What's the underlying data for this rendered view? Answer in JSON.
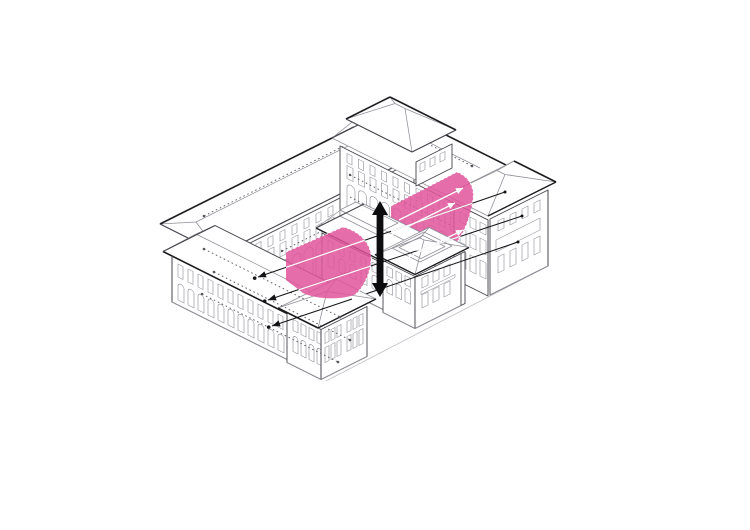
{
  "meta": {
    "title": "Courtyard building axonometric diagram",
    "description": "Line-drawn axonometric of a U-shaped courtyard building complex with a low middle cross wing. Two pink vertical screen surfaces span the two courtyards, crossed by flow arrows, with a thick black vertical double-headed arrow between them.",
    "diagram_type": "architectural-axonometric"
  },
  "colors": {
    "background": "#ffffff",
    "highlight_pink": "#e0559b",
    "pink_opacity": "0.85",
    "line_heavy": "#1b1b1e",
    "line_medium": "#45454c",
    "line_light": "#8e8e96",
    "window_line": "#9b9ba3",
    "dotted_line": "#55555c",
    "ground_line": "#c4c4ca",
    "flow_black": "#141417",
    "flow_white": "#ffffff",
    "arrow_black": "#0d0d0f"
  },
  "diagram": {
    "buildings": [
      {
        "name": "front-left-wing",
        "storeys_visible": 2,
        "window_style": "rect-over-arched"
      },
      {
        "name": "back-left-wing",
        "storeys_visible": 3,
        "window_style": "arcade-ground-floor"
      },
      {
        "name": "back-right-wing",
        "storeys_visible": 3,
        "window_style": "arcade-ground-floor"
      },
      {
        "name": "north-corner-pavilion",
        "storeys_visible": 1,
        "window_style": "small"
      },
      {
        "name": "east-end-pavilion",
        "storeys_visible": 3,
        "window_style": "rect"
      },
      {
        "name": "middle-cross-wing",
        "storeys_visible": 2,
        "features": [
          "roof-monitor",
          "rooftop-skylight"
        ]
      }
    ],
    "screens": [
      {
        "name": "left-courtyard-screen",
        "color_ref": "highlight_pink",
        "edge": "dashed-white"
      },
      {
        "name": "right-courtyard-screen",
        "color_ref": "highlight_pink",
        "edge": "dashed-white"
      }
    ],
    "annotations": {
      "vertical_double_arrow_count": 1,
      "black_flow_arrow_count": 3,
      "white_flow_arrow_count": 3,
      "dotted_guide_lines": true,
      "leader_dots": true
    }
  }
}
